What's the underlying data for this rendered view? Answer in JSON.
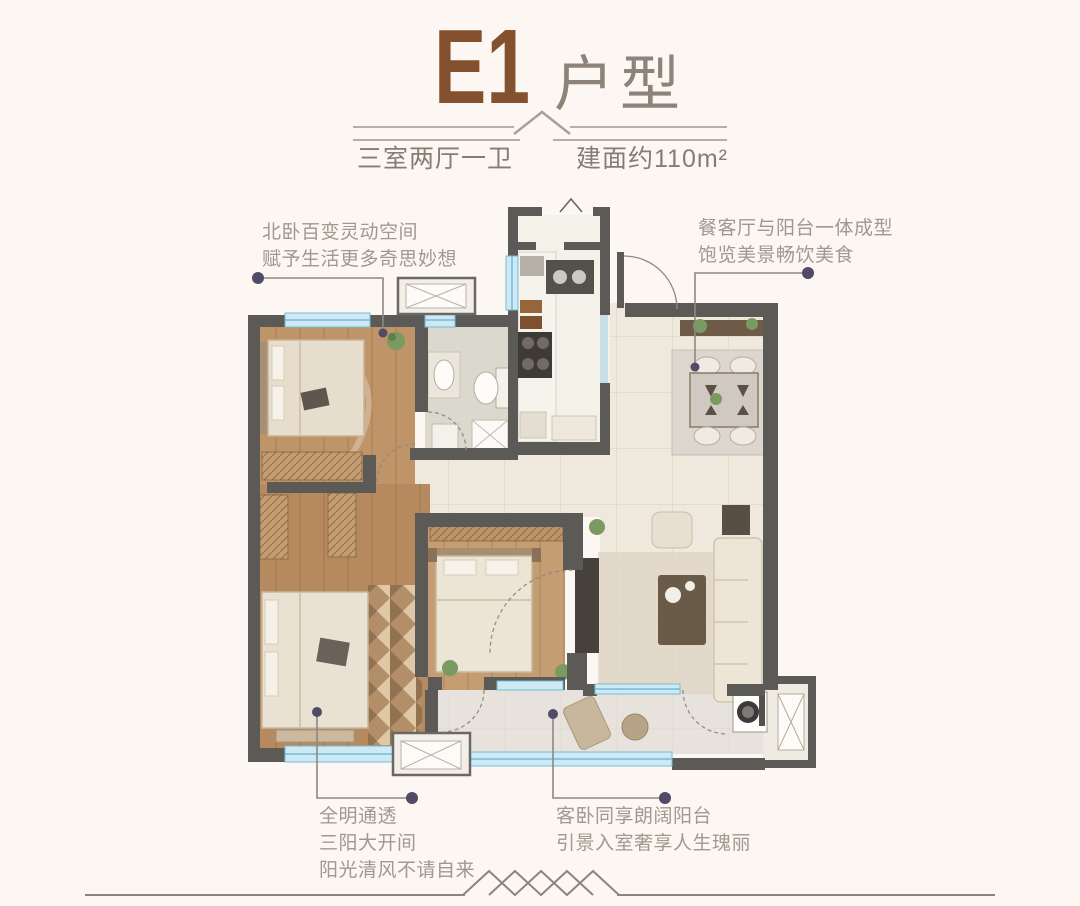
{
  "header": {
    "title": "E1",
    "title_suffix": "户型",
    "spec_left": "三室两厅一卫",
    "spec_right": "建面约110m²"
  },
  "annotations": {
    "north_bedroom": {
      "line1": "北卧百变灵动空间",
      "line2": "赋予生活更多奇思妙想"
    },
    "dining": {
      "line1": "餐客厅与阳台一体成型",
      "line2": "饱览美景畅饮美食"
    },
    "master": {
      "line1": "全明通透",
      "line2": "三阳大开间",
      "line3": "阳光清风不请自来"
    },
    "balcony": {
      "line1": "客卧同享朗阔阳台",
      "line2": "引景入室奢享人生瑰丽"
    }
  },
  "colors": {
    "background": "#fcf7f2",
    "title_brown": "#84512e",
    "title_suffix_gray": "#8d8379",
    "spec_text": "#857d73",
    "annotation_text": "#a1988e",
    "leader_line": "#8e8880",
    "leader_dot": "#504b66",
    "wall": "#5c5a57",
    "window_blue": "#74bcd8",
    "window_fill": "#cfe9f4",
    "wood_floor": "#bb9167",
    "tile_floor": "#efe8dd",
    "decor_line": "#8b857d"
  }
}
